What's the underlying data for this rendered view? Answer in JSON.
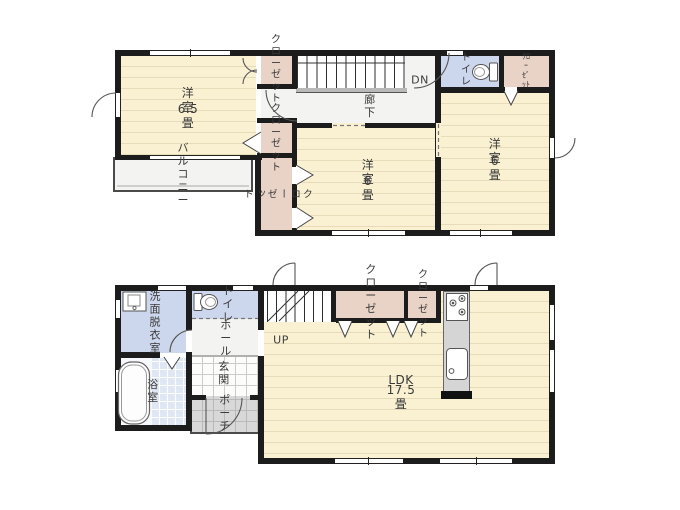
{
  "colors": {
    "wall": "#1c1c1c",
    "room": "#faf1d3",
    "closet": "#e9d3c7",
    "wet": "#ccd6ec",
    "hall": "#f3f3f1",
    "tile": "#dfe6f4",
    "porch": "#d8d8d8",
    "unit": "#d5d5d5"
  },
  "floor2": {
    "room1_name": "洋室",
    "room1_size": "6.5畳",
    "room2_name": "洋室",
    "room2_size": "6畳",
    "room3_name": "洋室",
    "room3_size": "6畳",
    "balcony": "バルコニー",
    "closet_a": "クロー\nゼット",
    "closet_b": "クロー\nゼット",
    "closet_c": "クローゼット",
    "closet_d": "ｸﾛｰｾﾞｯﾄ",
    "hallway": "廊下",
    "toilet": "トイレ",
    "stairs_down": "DN"
  },
  "floor1": {
    "washroom": "洗面脱衣室",
    "toilet": "トイレ",
    "bath": "浴室",
    "hall": "ホール",
    "entrance": "玄関",
    "porch": "ポーチ",
    "stairs_up": "UP",
    "closet_a": "クローゼット",
    "closet_b": "クロー\nゼット",
    "ldk_name": "LDK",
    "ldk_size": "17.5畳"
  },
  "icons": {
    "toilet": "toilet-icon",
    "washbasin": "washbasin-icon",
    "bathtub": "bathtub-icon",
    "stove": "stove-icon",
    "kitchen_sink": "kitchen-sink-icon"
  }
}
